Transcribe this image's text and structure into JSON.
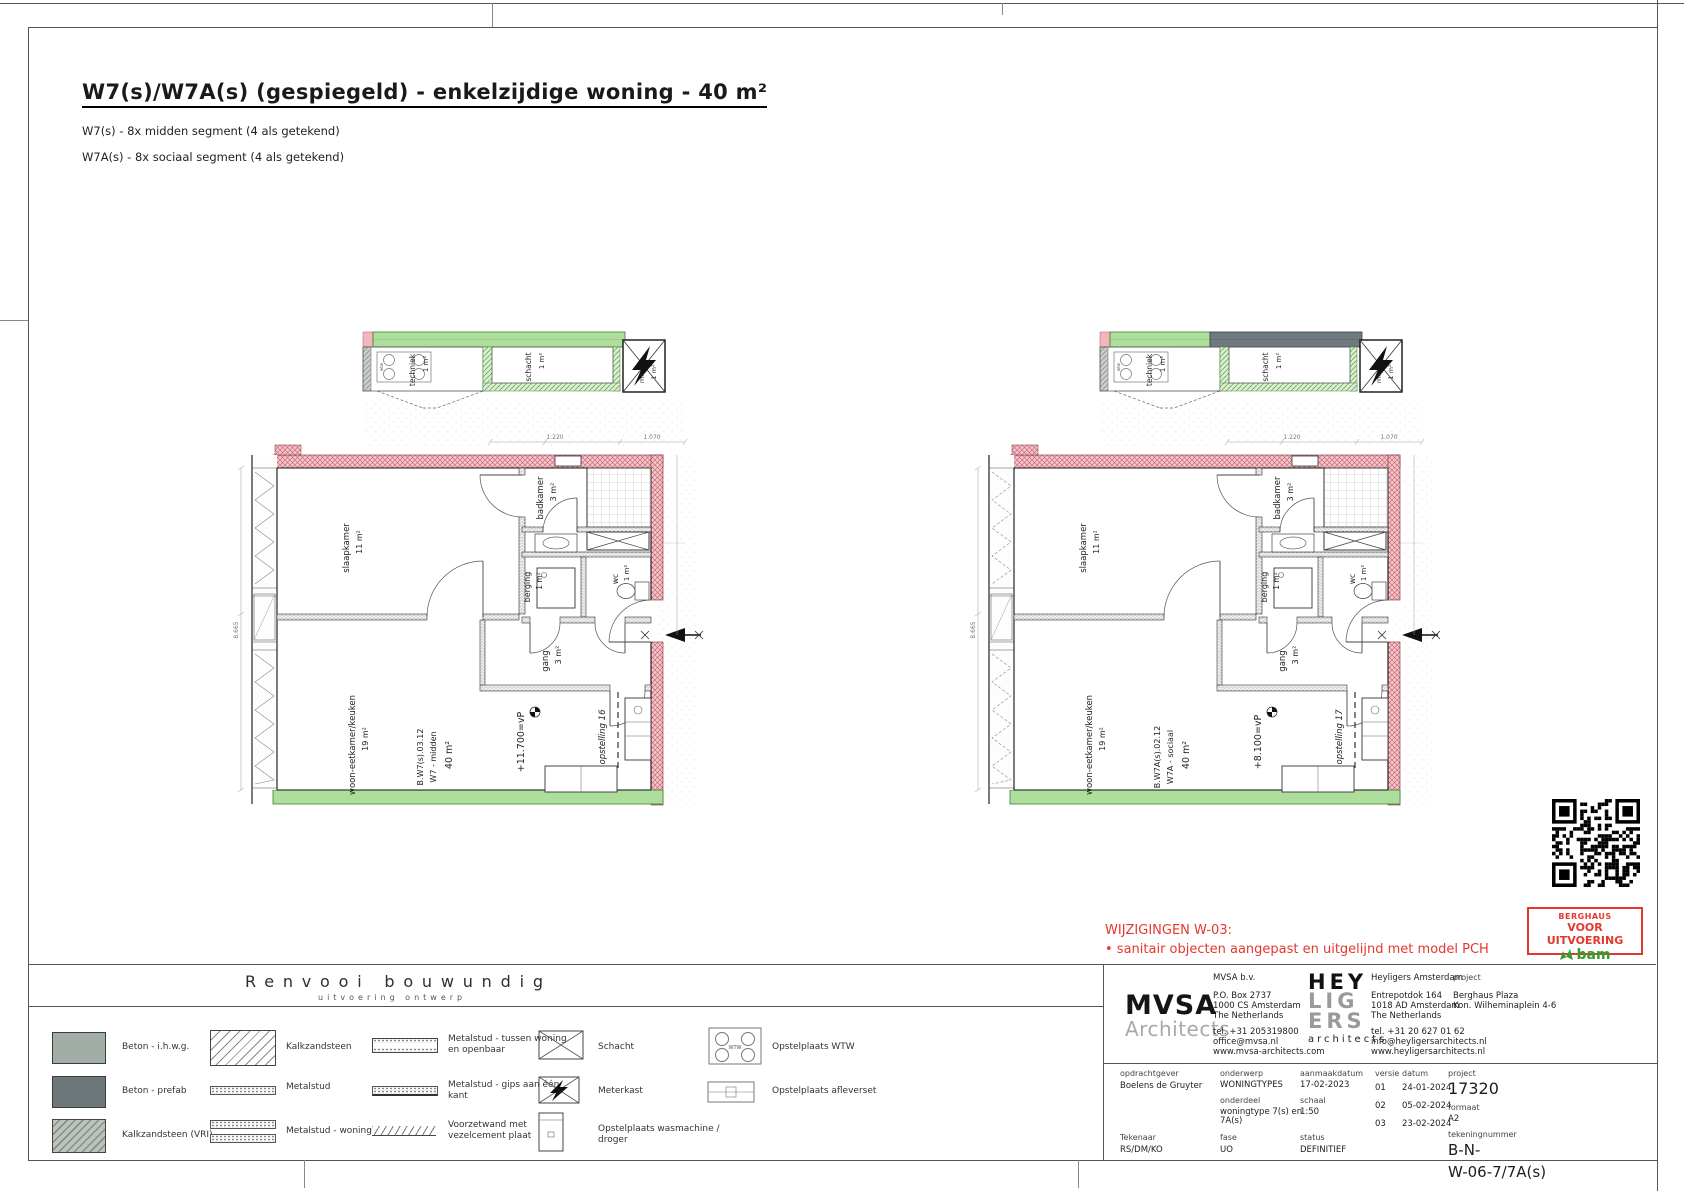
{
  "page": {
    "title": "W7(s)/W7A(s) (gespiegeld) - enkelzijdige woning - 40 m²",
    "subtitle1": "W7(s) - 8x midden segment (4 als getekend)",
    "subtitle2": "W7A(s) - 8x sociaal segment (4 als getekend)"
  },
  "plans": [
    {
      "id": "W7",
      "annex": {
        "techniek": {
          "label": "techniek",
          "area": "1 m²"
        },
        "schacht": {
          "label": "schacht",
          "area": "1 m²"
        },
        "mk": {
          "label": "mk",
          "area": "1 m²"
        },
        "wtw_label": "wtw"
      },
      "rooms": {
        "slaapkamer": {
          "label": "slaapkamer",
          "area": "11 m²"
        },
        "badkamer": {
          "label": "badkamer",
          "area": "3 m²"
        },
        "berging": {
          "label": "berging",
          "area": "1 m²"
        },
        "wc": {
          "label": "wc",
          "area": "1 m²"
        },
        "gang": {
          "label": "gang",
          "area": "3 m²"
        },
        "woonkamer": {
          "label": "woon-eetkamer/keuken",
          "area": "19 m²"
        }
      },
      "unit": {
        "code": "B.W7(s).03.12",
        "type": "W7 - midden",
        "area": "40 m²"
      },
      "level": "+11.700=vP",
      "opstelling": "opstelling 16",
      "dims": {
        "left": "8.665",
        "top1": "1.220",
        "top2": "1.070"
      }
    },
    {
      "id": "W7A",
      "annex": {
        "techniek": {
          "label": "techniek",
          "area": "1 m²"
        },
        "schacht": {
          "label": "schacht",
          "area": "1 m²"
        },
        "mk": {
          "label": "mk",
          "area": "1 m²"
        },
        "wtw_label": "wtw"
      },
      "rooms": {
        "slaapkamer": {
          "label": "slaapkamer",
          "area": "11 m²"
        },
        "badkamer": {
          "label": "badkamer",
          "area": "3 m²"
        },
        "berging": {
          "label": "berging",
          "area": "1 m²"
        },
        "wc": {
          "label": "wc",
          "area": "1 m²"
        },
        "gang": {
          "label": "gang",
          "area": "3 m²"
        },
        "woonkamer": {
          "label": "woon-eetkamer/keuken",
          "area": "19 m²"
        }
      },
      "unit": {
        "code": "B.W7A(s).02.12",
        "type": "W7A - sociaal",
        "area": "40 m²"
      },
      "level": "+8.100=vP",
      "opstelling": "opstelling 17",
      "dims": {
        "left": "8.665",
        "top1": "1.220",
        "top2": "1.070"
      }
    }
  ],
  "changes": {
    "title": "WIJZIGINGEN W-03:",
    "item": "• sanitair objecten aangepast en uitgelijnd met model PCH"
  },
  "stamp": {
    "line1": "BERGHAUS",
    "line2": "VOOR UITVOERING",
    "brand": "bam"
  },
  "legend": {
    "title": "Renvooi bouwundig",
    "subtitle": "uitvoering ontwerp",
    "wtw_icon_text": "WTW",
    "items": [
      {
        "label": "Beton - i.h.w.g.",
        "icon": "beton-ihwg"
      },
      {
        "label": "Beton - prefab",
        "icon": "beton-prefab"
      },
      {
        "label": "Kalkzandsteen (VRI)",
        "icon": "kalkzandsteen-vri"
      },
      {
        "label": "Kalkzandsteen",
        "icon": "kalkzandsteen"
      },
      {
        "label": "Metalstud",
        "icon": "metalstud"
      },
      {
        "label": "Metalstud - woningscheidend",
        "icon": "metalstud-woningscheidend"
      },
      {
        "label": "Metalstud - tussen woning en openbaar",
        "icon": "metalstud-tussen"
      },
      {
        "label": "Metalstud - gips aan één kant",
        "icon": "metalstud-gips"
      },
      {
        "label": "Voorzetwand met vezelcement plaat",
        "icon": "voorzetwand"
      },
      {
        "label": "Schacht",
        "icon": "schacht"
      },
      {
        "label": "Meterkast",
        "icon": "meterkast"
      },
      {
        "label": "Opstelplaats wasmachine / droger",
        "icon": "wasmachine"
      },
      {
        "label": "Opstelplaats WTW",
        "icon": "wtw"
      },
      {
        "label": "Opstelplaats afleverset",
        "icon": "afleverset"
      }
    ]
  },
  "titleblock": {
    "mvsa": {
      "name1": "MVSA",
      "name2": "Architects",
      "company": "MVSA b.v.",
      "addr1": "P.O. Box 2737",
      "addr2": "1000 CS Amsterdam",
      "addr3": "The Netherlands",
      "tel": "tel. +31 205319800",
      "email": "office@mvsa.nl",
      "web": "www.mvsa-architects.com"
    },
    "heyligers": {
      "logo1": "HEY",
      "logo2": "LIG",
      "logo3": "ERS",
      "logo_sub": "architects",
      "company": "Heyligers Amsterdam",
      "addr1": "Entrepotdok 164",
      "addr2": "1018 AD Amsterdam",
      "addr3": "The Netherlands",
      "tel": "tel. +31 20 627 01 62",
      "email": "info@heyligersarchitects.nl",
      "web": "www.heyligersarchitects.nl"
    },
    "project_label": "project",
    "project_name": "Berghaus Plaza",
    "project_addr": "Kon. Wilheminaplein 4-6",
    "fields": {
      "opdrachtgever_label": "opdrachtgever",
      "opdrachtgever": "Boelens de Gruyter",
      "onderwerp_label": "onderwerp",
      "onderwerp": "WONINGTYPES",
      "onderdeel_label": "onderdeel",
      "onderdeel1": "woningtype 7(s) en",
      "onderdeel2": "7A(s)",
      "aanmaakdatum_label": "aanmaakdatum",
      "aanmaakdatum": "17-02-2023",
      "schaal_label": "schaal",
      "schaal": "1:50",
      "versie_label": "versie",
      "datum_label": "datum",
      "versies": [
        {
          "v": "01",
          "d": "24-01-2024"
        },
        {
          "v": "02",
          "d": "05-02-2024"
        },
        {
          "v": "03",
          "d": "23-02-2024"
        }
      ],
      "project_num_label": "project",
      "project_num": "17320",
      "formaat_label": "formaat",
      "formaat": "A2",
      "tekeningnummer_label": "tekeningnummer",
      "tekeningnummer1": "B-N-",
      "tekeningnummer2": "W-06-7/7A(s)",
      "tekenaar_label": "Tekenaar",
      "tekenaar": "RS/DM/KO",
      "fase_label": "fase",
      "fase": "UO",
      "status_label": "status",
      "status": "DEFINITIEF"
    }
  },
  "colors": {
    "red": "#e4382e",
    "bam_green": "#2ca02c",
    "band_green": "#aede9b",
    "wall_pink": "#f5c4ca",
    "band_gray": "#6f7a80"
  }
}
